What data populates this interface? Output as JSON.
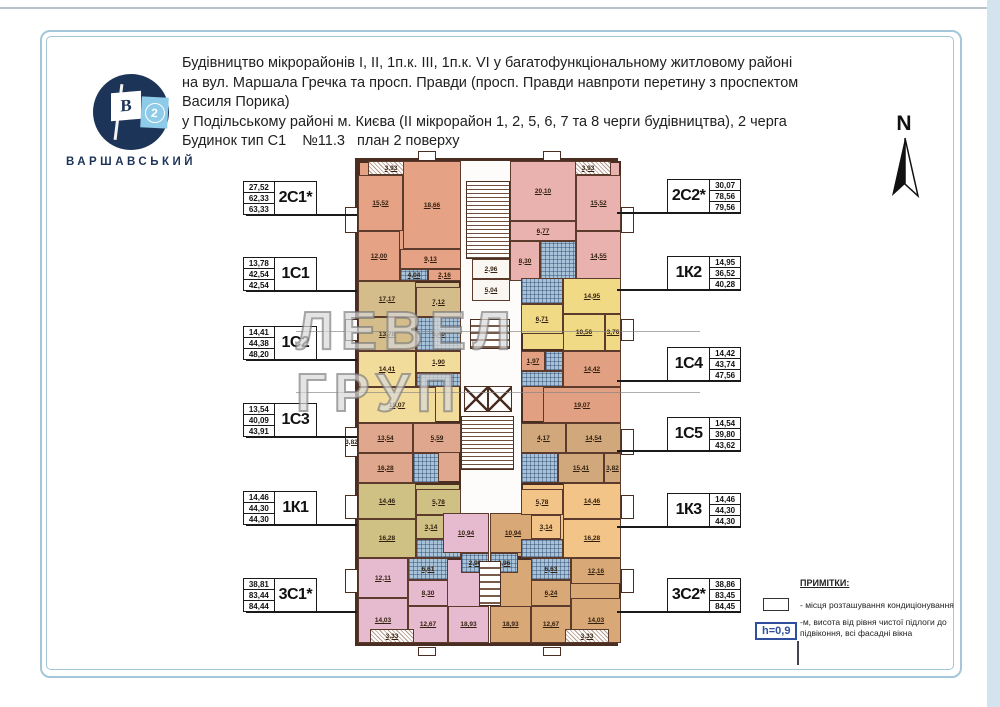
{
  "header": {
    "lines": [
      "Будівництво мікрорайонів I, II, 1п.к. III, 1п.к. VI у багатофункціональному житловому районі",
      "на вул. Маршала Гречка та просп. Правди (просп. Правди навпроти перетину з проспектом Василя Порика)",
      "у Подільському районі м. Києва (II мікрорайон 1, 2, 5, 6, 7 та 8 черги будівництва), 2 черга",
      "Будинок тип С1    №11.3   план 2 поверху"
    ]
  },
  "logo": {
    "letter": "B",
    "number": "2",
    "name": "ВАРШАВСЬКИЙ"
  },
  "north": {
    "label": "N"
  },
  "watermark": {
    "text": "ЛЕВЕЛ ГРУП"
  },
  "apartments": {
    "left": [
      {
        "code": "2С1*",
        "areas": [
          "27,52",
          "62,33",
          "63,33"
        ]
      },
      {
        "code": "1С1",
        "areas": [
          "13,78",
          "42,54",
          "42,54"
        ]
      },
      {
        "code": "1С2",
        "areas": [
          "14,41",
          "44,38",
          "48,20"
        ]
      },
      {
        "code": "1С3",
        "areas": [
          "13,54",
          "40,09",
          "43,91"
        ]
      },
      {
        "code": "1К1",
        "areas": [
          "14,46",
          "44,30",
          "44,30"
        ]
      },
      {
        "code": "3С1*",
        "areas": [
          "38,81",
          "83,44",
          "84,44"
        ]
      }
    ],
    "right": [
      {
        "code": "2С2*",
        "areas": [
          "30,07",
          "78,56",
          "79,56"
        ]
      },
      {
        "code": "1К2",
        "areas": [
          "14,95",
          "36,52",
          "40,28"
        ]
      },
      {
        "code": "1С4",
        "areas": [
          "14,42",
          "43,74",
          "47,56"
        ]
      },
      {
        "code": "1С5",
        "areas": [
          "14,54",
          "39,80",
          "43,62"
        ]
      },
      {
        "code": "1К3",
        "areas": [
          "14,46",
          "44,30",
          "44,30"
        ]
      },
      {
        "code": "3С2*",
        "areas": [
          "38,86",
          "83,45",
          "84,45"
        ]
      }
    ]
  },
  "notes": {
    "title": "ПРИМІТКИ:",
    "item_ac": "- місця розташування кондиціонування",
    "h_value": "h=0,9",
    "item_h": "-м, висота від рівня чистої підлоги до підвіконня, всі фасадні вікна"
  },
  "plan": {
    "colors": {
      "a2c1": "#e5a284",
      "a1c1": "#d4bd8b",
      "a1c2": "#f2dc9b",
      "a1c3": "#dfa78e",
      "a1k1": "#cfc083",
      "a3c1": "#e6bbd0",
      "a2c2": "#e9b2ae",
      "a1k2": "#f0da85",
      "a1c4": "#e2a083",
      "a1c5": "#d0a87c",
      "a1k3": "#f3c488",
      "a3c2": "#d9a877"
    },
    "rects": [
      {
        "x": 0,
        "y": 0,
        "w": 103,
        "h": 120,
        "c": "a2c1",
        "cls": "zone"
      },
      {
        "x": 0,
        "y": 120,
        "w": 103,
        "h": 70,
        "c": "a1c1",
        "cls": "zone"
      },
      {
        "x": 0,
        "y": 190,
        "w": 103,
        "h": 72,
        "c": "a1c2",
        "cls": "zone"
      },
      {
        "x": 0,
        "y": 262,
        "w": 103,
        "h": 60,
        "c": "a1c3",
        "cls": "zone"
      },
      {
        "x": 0,
        "y": 322,
        "w": 103,
        "h": 75,
        "c": "a1k1",
        "cls": "zone"
      },
      {
        "x": 0,
        "y": 397,
        "w": 131,
        "h": 85,
        "c": "a3c1",
        "cls": "zone"
      },
      {
        "x": 85,
        "y": 352,
        "w": 46,
        "h": 45,
        "c": "a3c1",
        "cls": "zone"
      },
      {
        "x": 160,
        "y": 0,
        "w": 103,
        "h": 120,
        "c": "a2c2",
        "cls": "zone"
      },
      {
        "x": 163,
        "y": 117,
        "w": 100,
        "h": 73,
        "c": "a1k2",
        "cls": "zone"
      },
      {
        "x": 163,
        "y": 190,
        "w": 100,
        "h": 72,
        "c": "a1c4",
        "cls": "zone"
      },
      {
        "x": 163,
        "y": 262,
        "w": 100,
        "h": 60,
        "c": "a1c5",
        "cls": "zone"
      },
      {
        "x": 163,
        "y": 322,
        "w": 100,
        "h": 75,
        "c": "a1k3",
        "cls": "zone"
      },
      {
        "x": 132,
        "y": 397,
        "w": 131,
        "h": 85,
        "c": "a3c2",
        "cls": "zone"
      },
      {
        "x": 132,
        "y": 352,
        "w": 46,
        "h": 45,
        "c": "a3c2",
        "cls": "zone"
      },
      {
        "x": 60,
        "y": -10,
        "w": 18,
        "h": 10,
        "cls": "tab"
      },
      {
        "x": 185,
        "y": -10,
        "w": 18,
        "h": 10,
        "cls": "tab"
      },
      {
        "x": 60,
        "y": 486,
        "w": 18,
        "h": 9,
        "cls": "tab"
      },
      {
        "x": 185,
        "y": 486,
        "w": 18,
        "h": 9,
        "cls": "tab"
      },
      {
        "x": -13,
        "y": 46,
        "w": 13,
        "h": 26,
        "cls": "bay"
      },
      {
        "x": -13,
        "y": 158,
        "w": 13,
        "h": 22,
        "cls": "bay"
      },
      {
        "x": -13,
        "y": 266,
        "w": 13,
        "h": 30,
        "cls": "bay",
        "l": "3,82"
      },
      {
        "x": -13,
        "y": 334,
        "w": 13,
        "h": 24,
        "cls": "bay"
      },
      {
        "x": -13,
        "y": 408,
        "w": 13,
        "h": 24,
        "cls": "bay"
      },
      {
        "x": 263,
        "y": 46,
        "w": 13,
        "h": 26,
        "cls": "bay"
      },
      {
        "x": 263,
        "y": 158,
        "w": 13,
        "h": 22,
        "cls": "bay"
      },
      {
        "x": 263,
        "y": 268,
        "w": 13,
        "h": 26,
        "cls": "bay"
      },
      {
        "x": 263,
        "y": 334,
        "w": 13,
        "h": 24,
        "cls": "bay"
      },
      {
        "x": 263,
        "y": 408,
        "w": 13,
        "h": 24,
        "cls": "bay"
      },
      {
        "x": 10,
        "y": 0,
        "w": 46,
        "h": 14,
        "cls": "hatch",
        "l": "3,93"
      },
      {
        "x": 0,
        "y": 14,
        "w": 45,
        "h": 56,
        "c": "a2c1",
        "l": "15,52"
      },
      {
        "x": 45,
        "y": 0,
        "w": 58,
        "h": 88,
        "c": "a2c1",
        "l": "18,66"
      },
      {
        "x": 0,
        "y": 70,
        "w": 42,
        "h": 50,
        "c": "a2c1",
        "l": "12,00"
      },
      {
        "x": 42,
        "y": 88,
        "w": 61,
        "h": 20,
        "c": "a2c1",
        "l": "9,13"
      },
      {
        "x": 42,
        "y": 108,
        "w": 28,
        "h": 12,
        "cls": "tile",
        "l": "4,04"
      },
      {
        "x": 70,
        "y": 108,
        "w": 33,
        "h": 12,
        "c": "a2c1",
        "l": "2,16"
      },
      {
        "x": 0,
        "y": 120,
        "w": 58,
        "h": 36,
        "c": "a1c1",
        "l": "17,17"
      },
      {
        "x": 58,
        "y": 126,
        "w": 45,
        "h": 30,
        "c": "a1c1",
        "l": "7,12"
      },
      {
        "x": 0,
        "y": 156,
        "w": 58,
        "h": 34,
        "c": "a1c1",
        "l": "13,78"
      },
      {
        "x": 58,
        "y": 156,
        "w": 45,
        "h": 34,
        "cls": "tile",
        "l": "5,40"
      },
      {
        "x": 0,
        "y": 190,
        "w": 58,
        "h": 36,
        "c": "a1c2",
        "l": "14,41"
      },
      {
        "x": 58,
        "y": 190,
        "w": 45,
        "h": 22,
        "c": "a1c2",
        "l": "1,90"
      },
      {
        "x": 58,
        "y": 212,
        "w": 45,
        "h": 14,
        "cls": "tile"
      },
      {
        "x": 0,
        "y": 226,
        "w": 78,
        "h": 36,
        "c": "a1c2",
        "l": "19,07"
      },
      {
        "x": 0,
        "y": 262,
        "w": 55,
        "h": 30,
        "c": "a1c3",
        "l": "13,54"
      },
      {
        "x": 55,
        "y": 262,
        "w": 48,
        "h": 30,
        "c": "a1c3",
        "l": "5,59"
      },
      {
        "x": 0,
        "y": 292,
        "w": 55,
        "h": 30,
        "c": "a1c3",
        "l": "16,28"
      },
      {
        "x": 55,
        "y": 292,
        "w": 26,
        "h": 30,
        "cls": "tile"
      },
      {
        "x": 0,
        "y": 322,
        "w": 58,
        "h": 36,
        "c": "a1k1",
        "l": "14,46"
      },
      {
        "x": 58,
        "y": 328,
        "w": 45,
        "h": 26,
        "c": "a1k1",
        "l": "5,78"
      },
      {
        "x": 0,
        "y": 358,
        "w": 58,
        "h": 39,
        "c": "a1k1",
        "l": "16,28"
      },
      {
        "x": 58,
        "y": 354,
        "w": 30,
        "h": 24,
        "c": "a1k1",
        "l": "3,14"
      },
      {
        "x": 58,
        "y": 378,
        "w": 45,
        "h": 19,
        "cls": "tile"
      },
      {
        "x": 85,
        "y": 352,
        "w": 46,
        "h": 40,
        "c": "a3c1",
        "l": "10,94"
      },
      {
        "x": 103,
        "y": 392,
        "w": 28,
        "h": 20,
        "cls": "tile",
        "l": "2,96"
      },
      {
        "x": 0,
        "y": 397,
        "w": 50,
        "h": 40,
        "c": "a3c1",
        "l": "12,11"
      },
      {
        "x": 50,
        "y": 397,
        "w": 40,
        "h": 22,
        "cls": "tile",
        "l": "6,61"
      },
      {
        "x": 50,
        "y": 419,
        "w": 40,
        "h": 26,
        "c": "a3c1",
        "l": "8,30"
      },
      {
        "x": 0,
        "y": 437,
        "w": 50,
        "h": 45,
        "c": "a3c1",
        "l": "14,03"
      },
      {
        "x": 50,
        "y": 445,
        "w": 40,
        "h": 37,
        "c": "a3c1",
        "l": "12,67"
      },
      {
        "x": 90,
        "y": 445,
        "w": 41,
        "h": 37,
        "c": "a3c1",
        "l": "18,93"
      },
      {
        "x": 12,
        "y": 468,
        "w": 44,
        "h": 14,
        "cls": "hatch",
        "l": "3,33"
      },
      {
        "x": 132,
        "y": 352,
        "w": 46,
        "h": 40,
        "c": "a3c2",
        "l": "10,94"
      },
      {
        "x": 132,
        "y": 392,
        "w": 28,
        "h": 20,
        "cls": "tile",
        "l": "2,96"
      },
      {
        "x": 213,
        "y": 397,
        "w": 50,
        "h": 26,
        "c": "a3c2",
        "l": "12,16"
      },
      {
        "x": 173,
        "y": 397,
        "w": 40,
        "h": 22,
        "cls": "tile",
        "l": "6,63"
      },
      {
        "x": 173,
        "y": 419,
        "w": 40,
        "h": 26,
        "c": "a3c2",
        "l": "6,24"
      },
      {
        "x": 213,
        "y": 437,
        "w": 50,
        "h": 45,
        "c": "a3c2",
        "l": "14,03"
      },
      {
        "x": 173,
        "y": 445,
        "w": 40,
        "h": 37,
        "c": "a3c2",
        "l": "12,67"
      },
      {
        "x": 132,
        "y": 445,
        "w": 41,
        "h": 37,
        "c": "a3c2",
        "l": "18,93"
      },
      {
        "x": 207,
        "y": 468,
        "w": 44,
        "h": 14,
        "cls": "hatch",
        "l": "3,33"
      },
      {
        "x": 207,
        "y": 0,
        "w": 46,
        "h": 14,
        "cls": "hatch",
        "l": "3,93"
      },
      {
        "x": 152,
        "y": 0,
        "w": 66,
        "h": 60,
        "c": "a2c2",
        "l": "20,10"
      },
      {
        "x": 218,
        "y": 14,
        "w": 45,
        "h": 56,
        "c": "a2c2",
        "l": "15,52"
      },
      {
        "x": 218,
        "y": 70,
        "w": 45,
        "h": 50,
        "c": "a2c2",
        "l": "14,55"
      },
      {
        "x": 152,
        "y": 60,
        "w": 66,
        "h": 20,
        "c": "a2c2",
        "l": "6,77"
      },
      {
        "x": 152,
        "y": 80,
        "w": 30,
        "h": 40,
        "c": "a2c2",
        "l": "8,30"
      },
      {
        "x": 182,
        "y": 80,
        "w": 36,
        "h": 40,
        "cls": "tile"
      },
      {
        "x": 163,
        "y": 117,
        "w": 42,
        "h": 26,
        "cls": "tile"
      },
      {
        "x": 205,
        "y": 117,
        "w": 58,
        "h": 36,
        "c": "a1k2",
        "l": "14,95"
      },
      {
        "x": 163,
        "y": 143,
        "w": 42,
        "h": 30,
        "c": "a1k2",
        "l": "6,71"
      },
      {
        "x": 205,
        "y": 153,
        "w": 42,
        "h": 37,
        "c": "a1k2",
        "l": "10,56"
      },
      {
        "x": 247,
        "y": 153,
        "w": 16,
        "h": 37,
        "c": "a1k2",
        "l": "3,76"
      },
      {
        "x": 163,
        "y": 190,
        "w": 24,
        "h": 20,
        "c": "a1c4",
        "l": "1,97"
      },
      {
        "x": 187,
        "y": 190,
        "w": 18,
        "h": 20,
        "cls": "tile"
      },
      {
        "x": 205,
        "y": 190,
        "w": 58,
        "h": 36,
        "c": "a1c4",
        "l": "14,42"
      },
      {
        "x": 163,
        "y": 210,
        "w": 42,
        "h": 16,
        "cls": "tile"
      },
      {
        "x": 185,
        "y": 226,
        "w": 78,
        "h": 36,
        "c": "a1c4",
        "l": "19,07"
      },
      {
        "x": 208,
        "y": 262,
        "w": 55,
        "h": 30,
        "c": "a1c5",
        "l": "14,54"
      },
      {
        "x": 163,
        "y": 262,
        "w": 45,
        "h": 30,
        "c": "a1c5",
        "l": "4,17"
      },
      {
        "x": 200,
        "y": 292,
        "w": 46,
        "h": 30,
        "c": "a1c5",
        "l": "15,41"
      },
      {
        "x": 246,
        "y": 292,
        "w": 17,
        "h": 30,
        "c": "a1c5",
        "l": "3,82"
      },
      {
        "x": 163,
        "y": 292,
        "w": 37,
        "h": 30,
        "cls": "tile"
      },
      {
        "x": 205,
        "y": 322,
        "w": 58,
        "h": 36,
        "c": "a1k3",
        "l": "14,46"
      },
      {
        "x": 163,
        "y": 328,
        "w": 42,
        "h": 26,
        "c": "a1k3",
        "l": "5,78"
      },
      {
        "x": 205,
        "y": 358,
        "w": 58,
        "h": 39,
        "c": "a1k3",
        "l": "16,28"
      },
      {
        "x": 173,
        "y": 354,
        "w": 30,
        "h": 24,
        "c": "a1k3",
        "l": "3,14"
      },
      {
        "x": 163,
        "y": 378,
        "w": 42,
        "h": 19,
        "cls": "tile"
      },
      {
        "x": 108,
        "y": 20,
        "w": 44,
        "h": 78,
        "cls": "stairs"
      },
      {
        "x": 114,
        "y": 98,
        "w": 38,
        "h": 20,
        "cls": "core",
        "l": "2,96"
      },
      {
        "x": 114,
        "y": 118,
        "w": 38,
        "h": 22,
        "cls": "core",
        "l": "5,04"
      },
      {
        "x": 112,
        "y": 158,
        "w": 40,
        "h": 30,
        "cls": "shaft"
      },
      {
        "x": 106,
        "y": 225,
        "w": 24,
        "h": 26,
        "cls": "lift"
      },
      {
        "x": 130,
        "y": 225,
        "w": 24,
        "h": 26,
        "cls": "lift"
      },
      {
        "x": 103,
        "y": 255,
        "w": 53,
        "h": 54,
        "cls": "stairs"
      },
      {
        "x": 121,
        "y": 400,
        "w": 22,
        "h": 45,
        "cls": "shaft"
      }
    ]
  }
}
